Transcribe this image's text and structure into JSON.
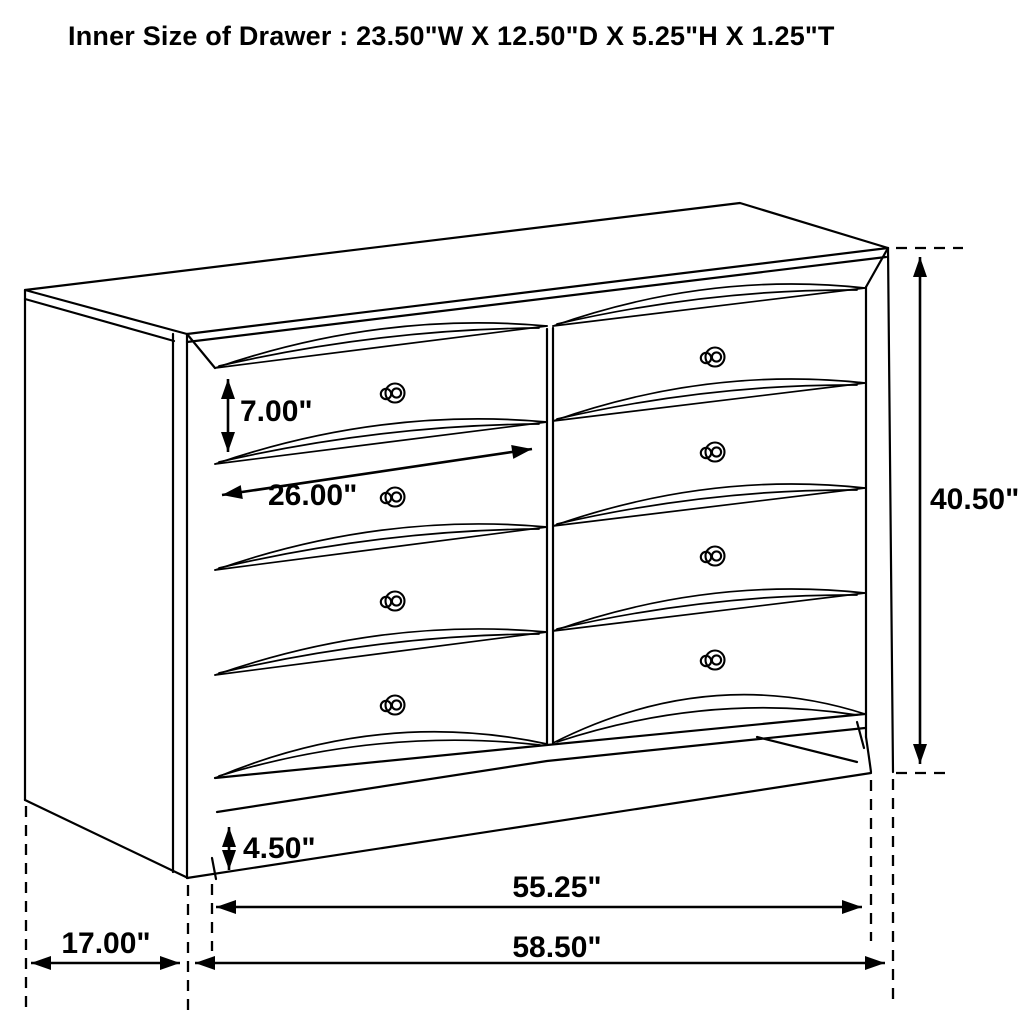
{
  "title": "Inner Size of Drawer : 23.50\"W X 12.50\"D X 5.25\"H X 1.25\"T",
  "dimensions": {
    "drawer_front_height": "7.00\"",
    "drawer_width": "26.00\"",
    "overall_height": "40.50\"",
    "base_height": "4.50\"",
    "inner_width": "55.25\"",
    "overall_width": "58.50\"",
    "depth": "17.00\""
  },
  "colors": {
    "line": "#000000",
    "background": "#ffffff"
  }
}
